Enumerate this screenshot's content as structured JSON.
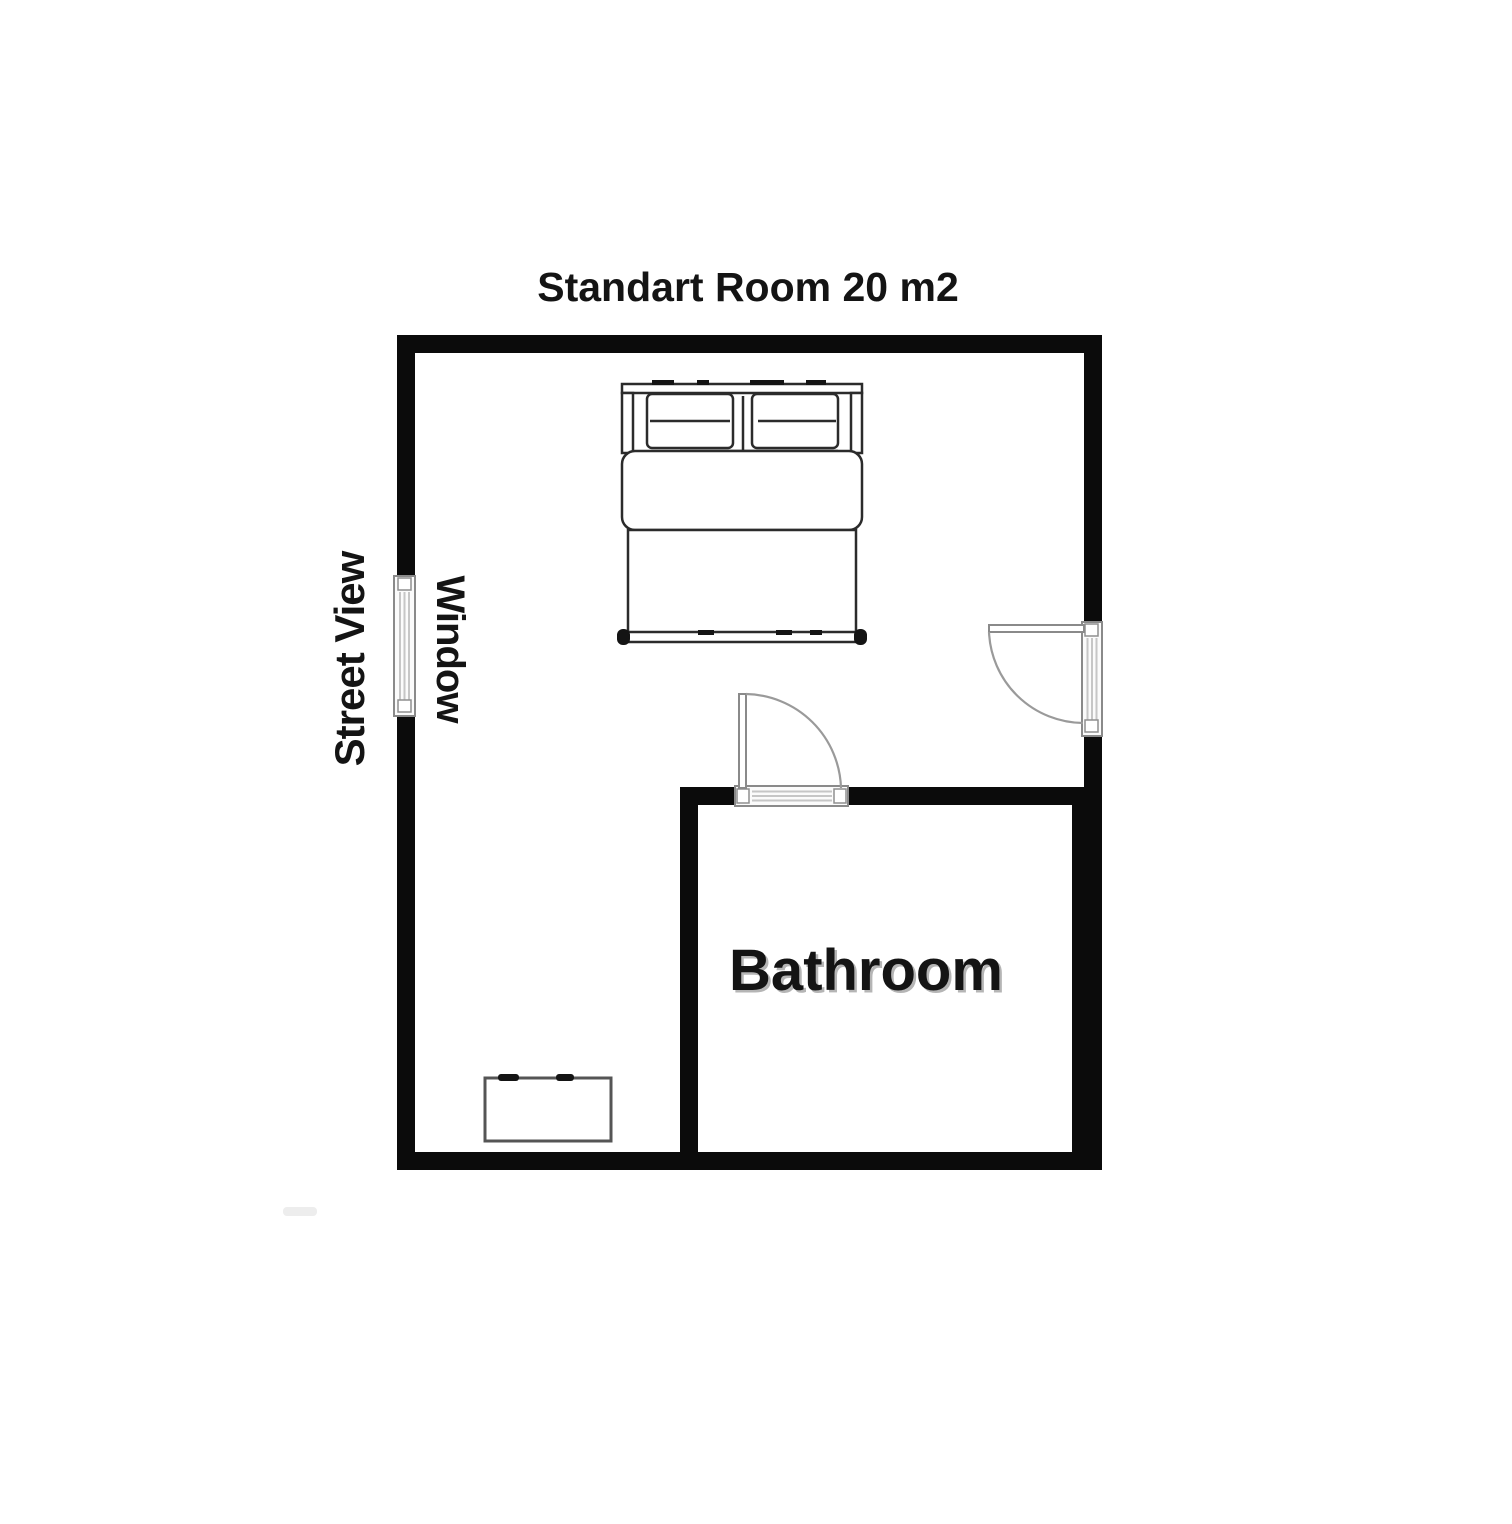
{
  "title": "Standart Room 20 m2",
  "labels": {
    "street_view": "Street View",
    "window": "Window",
    "bathroom": "Bathroom"
  },
  "colors": {
    "background": "#ffffff",
    "wall": "#0b0b0b",
    "furniture_line": "#2b2b2b",
    "door_line": "#9a9a9a",
    "glass_fill": "#fbfbfb",
    "text": "#141414"
  }
}
